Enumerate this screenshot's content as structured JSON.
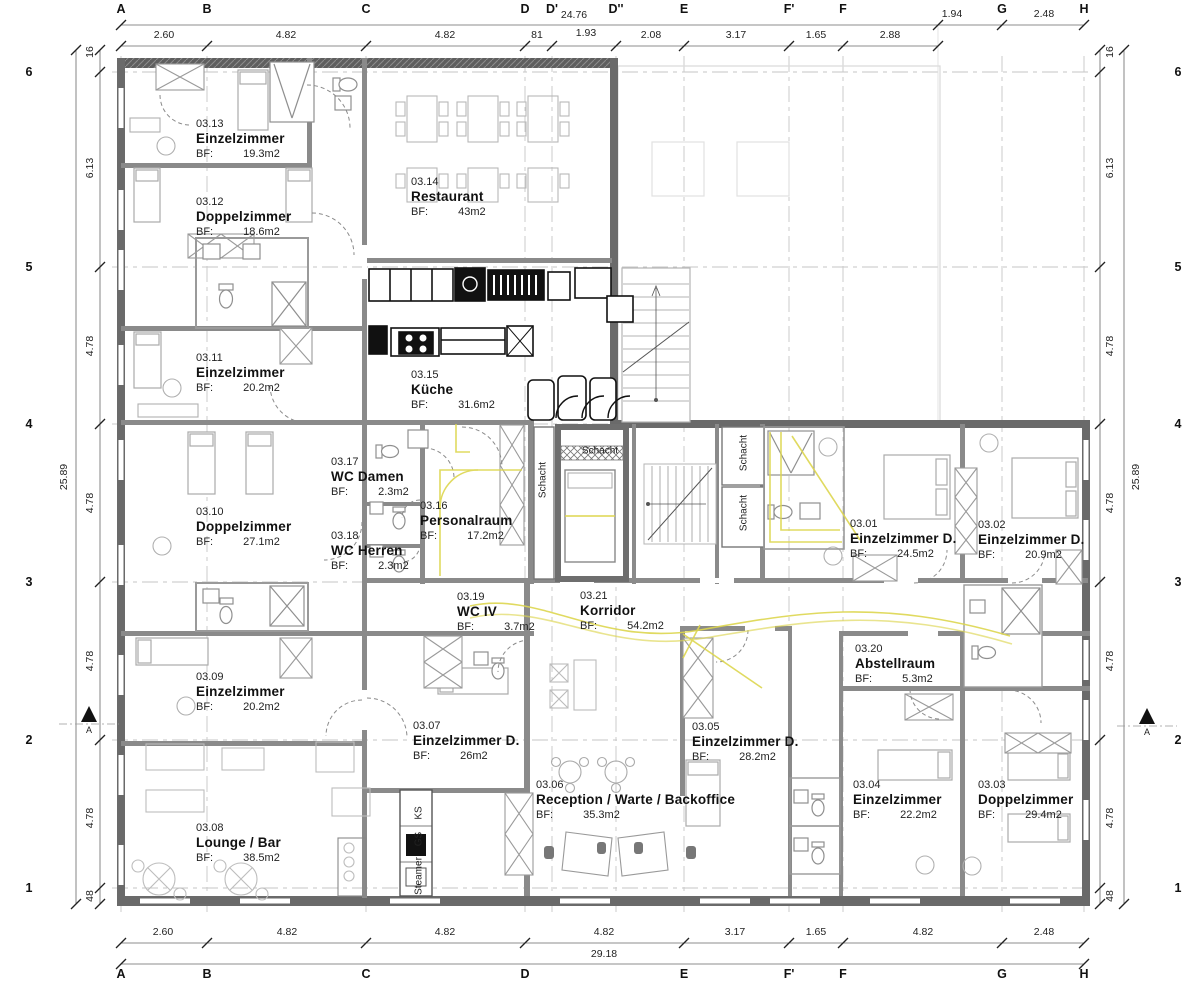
{
  "labels": {
    "bf_label": "BF:"
  },
  "colors": {
    "wall_dark": "#5f5f5f",
    "wall_mid": "#8a8a8a",
    "accent_yellow": "#ddd64f",
    "grid": "#c6c6c6"
  },
  "grid": {
    "columns": [
      {
        "label": "A",
        "x": 121,
        "bottom": true
      },
      {
        "label": "B",
        "x": 207,
        "bottom": true
      },
      {
        "label": "C",
        "x": 366,
        "bottom": true
      },
      {
        "label": "D",
        "x": 525,
        "bottom": true
      },
      {
        "label": "D'",
        "x": 552,
        "bottom": false
      },
      {
        "label": "D''",
        "x": 616,
        "bottom": false
      },
      {
        "label": "E",
        "x": 684,
        "bottom": true
      },
      {
        "label": "F'",
        "x": 789,
        "bottom": true
      },
      {
        "label": "F",
        "x": 843,
        "bottom": true
      },
      {
        "label": "G",
        "x": 1002,
        "bottom": true
      },
      {
        "label": "H",
        "x": 1084,
        "bottom": true
      }
    ],
    "rows": [
      {
        "label": "6",
        "y": 72
      },
      {
        "label": "5",
        "y": 267
      },
      {
        "label": "4",
        "y": 424
      },
      {
        "label": "3",
        "y": 582
      },
      {
        "label": "2",
        "y": 740
      },
      {
        "label": "1",
        "y": 888
      }
    ]
  },
  "dim_lines": [
    {
      "o": "h",
      "pos": 25,
      "from": 121,
      "to": 1084,
      "ticks": [
        121,
        938,
        1002,
        1084
      ]
    },
    {
      "o": "h",
      "pos": 46,
      "from": 121,
      "to": 938,
      "ticks": [
        121,
        207,
        366,
        525,
        552,
        616,
        684,
        789,
        843,
        938
      ]
    },
    {
      "o": "h",
      "pos": 943,
      "from": 121,
      "to": 1084,
      "ticks": [
        121,
        207,
        366,
        525,
        684,
        789,
        843,
        1002,
        1084
      ]
    },
    {
      "o": "h",
      "pos": 964,
      "from": 121,
      "to": 1084,
      "ticks": [
        121,
        1084
      ]
    },
    {
      "o": "v",
      "pos": 100,
      "from": 50,
      "to": 904,
      "ticks": [
        50,
        72,
        267,
        424,
        582,
        740,
        888,
        904
      ]
    },
    {
      "o": "v",
      "pos": 76,
      "from": 50,
      "to": 904,
      "ticks": [
        50,
        904
      ]
    },
    {
      "o": "v",
      "pos": 1100,
      "from": 50,
      "to": 904,
      "ticks": [
        50,
        72,
        267,
        424,
        582,
        740,
        888,
        904
      ]
    },
    {
      "o": "v",
      "pos": 1124,
      "from": 50,
      "to": 904,
      "ticks": [
        50,
        904
      ]
    }
  ],
  "dim_texts": [
    {
      "t": "2.60",
      "x": 164,
      "y": 35
    },
    {
      "t": "4.82",
      "x": 286,
      "y": 35
    },
    {
      "t": "4.82",
      "x": 445,
      "y": 35
    },
    {
      "t": "81",
      "x": 537,
      "y": 35
    },
    {
      "t": "1.93",
      "x": 586,
      "y": 33
    },
    {
      "t": "2.08",
      "x": 651,
      "y": 35
    },
    {
      "t": "3.17",
      "x": 736,
      "y": 35
    },
    {
      "t": "1.65",
      "x": 816,
      "y": 35
    },
    {
      "t": "2.88",
      "x": 890,
      "y": 35
    },
    {
      "t": "24.76",
      "x": 574,
      "y": 15
    },
    {
      "t": "1.94",
      "x": 952,
      "y": 14
    },
    {
      "t": "2.48",
      "x": 1044,
      "y": 14
    },
    {
      "t": "2.60",
      "x": 163,
      "y": 932
    },
    {
      "t": "4.82",
      "x": 287,
      "y": 932
    },
    {
      "t": "4.82",
      "x": 445,
      "y": 932
    },
    {
      "t": "4.82",
      "x": 604,
      "y": 932
    },
    {
      "t": "3.17",
      "x": 735,
      "y": 932
    },
    {
      "t": "1.65",
      "x": 816,
      "y": 932
    },
    {
      "t": "4.82",
      "x": 923,
      "y": 932
    },
    {
      "t": "2.48",
      "x": 1044,
      "y": 932
    },
    {
      "t": "29.18",
      "x": 604,
      "y": 954
    },
    {
      "t": "16",
      "x": 90,
      "y": 52,
      "v": true
    },
    {
      "t": "6.13",
      "x": 90,
      "y": 168,
      "v": true
    },
    {
      "t": "4.78",
      "x": 90,
      "y": 346,
      "v": true
    },
    {
      "t": "4.78",
      "x": 90,
      "y": 503,
      "v": true
    },
    {
      "t": "4.78",
      "x": 90,
      "y": 661,
      "v": true
    },
    {
      "t": "4.78",
      "x": 90,
      "y": 818,
      "v": true
    },
    {
      "t": "48",
      "x": 90,
      "y": 896,
      "v": true
    },
    {
      "t": "25.89",
      "x": 64,
      "y": 477,
      "v": true
    },
    {
      "t": "16",
      "x": 1110,
      "y": 52,
      "v": true
    },
    {
      "t": "6.13",
      "x": 1110,
      "y": 168,
      "v": true
    },
    {
      "t": "4.78",
      "x": 1110,
      "y": 346,
      "v": true
    },
    {
      "t": "4.78",
      "x": 1110,
      "y": 503,
      "v": true
    },
    {
      "t": "4.78",
      "x": 1110,
      "y": 661,
      "v": true
    },
    {
      "t": "4.78",
      "x": 1110,
      "y": 818,
      "v": true
    },
    {
      "t": "48",
      "x": 1110,
      "y": 896,
      "v": true
    },
    {
      "t": "25.89",
      "x": 1136,
      "y": 477,
      "v": true
    }
  ],
  "rooms": [
    {
      "id": "03.13",
      "name": "Einzelzimmer",
      "area": "19.3m2",
      "x": 196,
      "y": 118
    },
    {
      "id": "03.12",
      "name": "Doppelzimmer",
      "area": "18.6m2",
      "x": 196,
      "y": 196
    },
    {
      "id": "03.14",
      "name": "Restaurant",
      "area": "43m2",
      "x": 411,
      "y": 176
    },
    {
      "id": "03.11",
      "name": "Einzelzimmer",
      "area": "20.2m2",
      "x": 196,
      "y": 352
    },
    {
      "id": "03.15",
      "name": "Küche",
      "area": "31.6m2",
      "x": 411,
      "y": 369
    },
    {
      "id": "03.17",
      "name": "WC Damen",
      "area": "2.3m2",
      "x": 331,
      "y": 456
    },
    {
      "id": "03.16",
      "name": "Personalraum",
      "area": "17.2m2",
      "x": 420,
      "y": 500
    },
    {
      "id": "03.10",
      "name": "Doppelzimmer",
      "area": "27.1m2",
      "x": 196,
      "y": 506
    },
    {
      "id": "03.01",
      "name": "Einzelzimmer D.",
      "area": "24.5m2",
      "x": 850,
      "y": 518
    },
    {
      "id": "03.02",
      "name": "Einzelzimmer D.",
      "area": "20.9m2",
      "x": 978,
      "y": 519
    },
    {
      "id": "03.18",
      "name": "WC Herren",
      "area": "2.3m2",
      "x": 331,
      "y": 530
    },
    {
      "id": "03.19",
      "name": "WC IV",
      "area": "3.7m2",
      "x": 457,
      "y": 591
    },
    {
      "id": "03.21",
      "name": "Korridor",
      "area": "54.2m2",
      "x": 580,
      "y": 590
    },
    {
      "id": "03.20",
      "name": "Abstellraum",
      "area": "5.3m2",
      "x": 855,
      "y": 643
    },
    {
      "id": "03.09",
      "name": "Einzelzimmer",
      "area": "20.2m2",
      "x": 196,
      "y": 671
    },
    {
      "id": "03.07",
      "name": "Einzelzimmer D.",
      "area": "26m2",
      "x": 413,
      "y": 720
    },
    {
      "id": "03.05",
      "name": "Einzelzimmer D.",
      "area": "28.2m2",
      "x": 692,
      "y": 721
    },
    {
      "id": "03.06",
      "name": "Reception / Warte / Backoffice",
      "area": "35.3m2",
      "x": 536,
      "y": 779
    },
    {
      "id": "03.04",
      "name": "Einzelzimmer",
      "area": "22.2m2",
      "x": 853,
      "y": 779
    },
    {
      "id": "03.03",
      "name": "Doppelzimmer",
      "area": "29.4m2",
      "x": 978,
      "y": 779
    },
    {
      "id": "03.08",
      "name": "Lounge / Bar",
      "area": "38.5m2",
      "x": 196,
      "y": 822
    }
  ],
  "annotations": [
    {
      "t": "Schacht",
      "x": 543,
      "y": 480,
      "v": true
    },
    {
      "t": "Schacht",
      "x": 600,
      "y": 451,
      "v": false
    },
    {
      "t": "Schacht",
      "x": 744,
      "y": 453,
      "v": true
    },
    {
      "t": "Schacht",
      "x": 744,
      "y": 513,
      "v": true
    },
    {
      "t": "KS",
      "x": 419,
      "y": 813,
      "v": true
    },
    {
      "t": "GS",
      "x": 419,
      "y": 839,
      "v": true
    },
    {
      "t": "Steamer",
      "x": 419,
      "y": 876,
      "v": true
    }
  ],
  "section_markers": [
    {
      "label": "A",
      "x": 89,
      "y": 722
    },
    {
      "label": "A",
      "x": 1147,
      "y": 724
    }
  ]
}
